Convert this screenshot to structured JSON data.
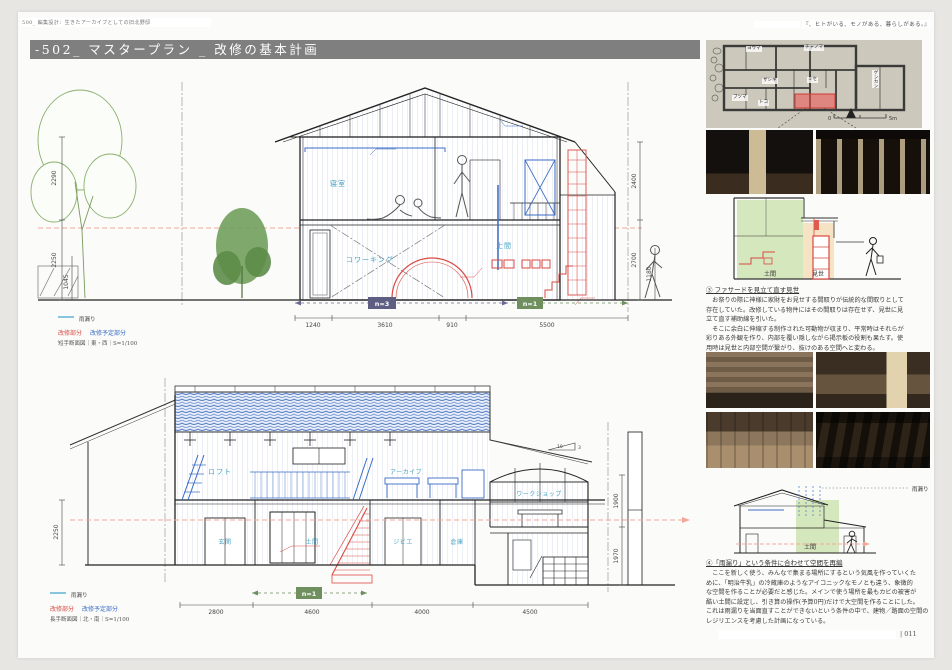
{
  "page": {
    "header_left": "500_ 編集設計：生きたアーカイブとしての旧北野邸",
    "header_right": "『、ヒトがいる、モノがある、暮らしがある。』",
    "title": "-502_ マスタープラン _ 改修の基本計画",
    "page_number": "| 011"
  },
  "legend": {
    "rain": "雨漏り",
    "renovated": "改修部分",
    "planned": "改修予定部分"
  },
  "drawing_top": {
    "caption": "短手断面図｜東・西｜S=1/100",
    "labels": {
      "bedroom": "寝室",
      "doma": "土間",
      "coworking": "コワーキング"
    },
    "badge_n3": "n=3",
    "badge_n1": "n=1",
    "dims_bottom": [
      "1240",
      "3610",
      "910",
      "5500"
    ],
    "dims_left": [
      "2290",
      "2250",
      "1045"
    ],
    "dims_right": [
      "2400",
      "2700",
      "1180"
    ]
  },
  "drawing_bottom": {
    "caption": "長手断面図｜北・南｜S=1/100",
    "labels": {
      "loft": "ロフト",
      "archive": "アーカイブ",
      "workshop": "ワークショップ",
      "genkan": "玄関",
      "doma": "土間",
      "gibier": "ジビエ",
      "storage": "倉庫"
    },
    "badge_n1": "n=1",
    "dims_bottom": [
      "2800",
      "4600",
      "4000",
      "4500"
    ],
    "dim_left": "2250",
    "dims_right": [
      "1900",
      "1970"
    ],
    "slope": {
      "run": "10",
      "rise": "3"
    }
  },
  "floorplan": {
    "rooms": {
      "youma": "ヨウマ",
      "chanoma": "チャノマ",
      "zashiki": "ザシキ",
      "mise": "ミセ",
      "genkan": "ゲンカン",
      "butsuma": "ブツマ",
      "toko": "トコ"
    },
    "scale_zero": "0",
    "scale_end": "5m"
  },
  "diagram1": {
    "doma": "土間",
    "mise": "見世"
  },
  "diagram2": {
    "rain": "雨漏り",
    "doma": "土間"
  },
  "section3": {
    "heading": "③ ファサードを見立て直す見世",
    "lines": [
      "　お祭りの際に神様に家財をお見せする間取りが伝統的な間取りとして",
      "存在していた。改修している物件にはその間取りは存在せず、見世に見",
      "立て直す補助線を引いた。",
      "　そこに余白に伸縮する制作された可動物が収まり、平常時はそれらが",
      "彩りある外観を作り、内部を覆い隠しながら掲示板の役割も果たす。使",
      "用時は見世と内部空間が繋がり、抜けのある空間へと変わる。"
    ]
  },
  "section4": {
    "heading": "④「雨漏り」という条件に合わせて空間を再編",
    "lines": [
      "　ここを新しく使う、みんなで集まる場所にするという気風を作っていくた",
      "めに、「明治牛乳」の冷蔵庫のようなアイコニックなモノとも違う、象徴的",
      "な空間を作ることが必要だと感じた。メインで使う場所を最もカビの被害が",
      "酷い土間に設定し、引き算の操作(予算0円)だけで大空間を作ることにした。",
      "これは雨漏りを当面直すことができないという条件の中で、建物／路面の空間の",
      "レジリエンスを考慮した計画になっている。"
    ]
  }
}
